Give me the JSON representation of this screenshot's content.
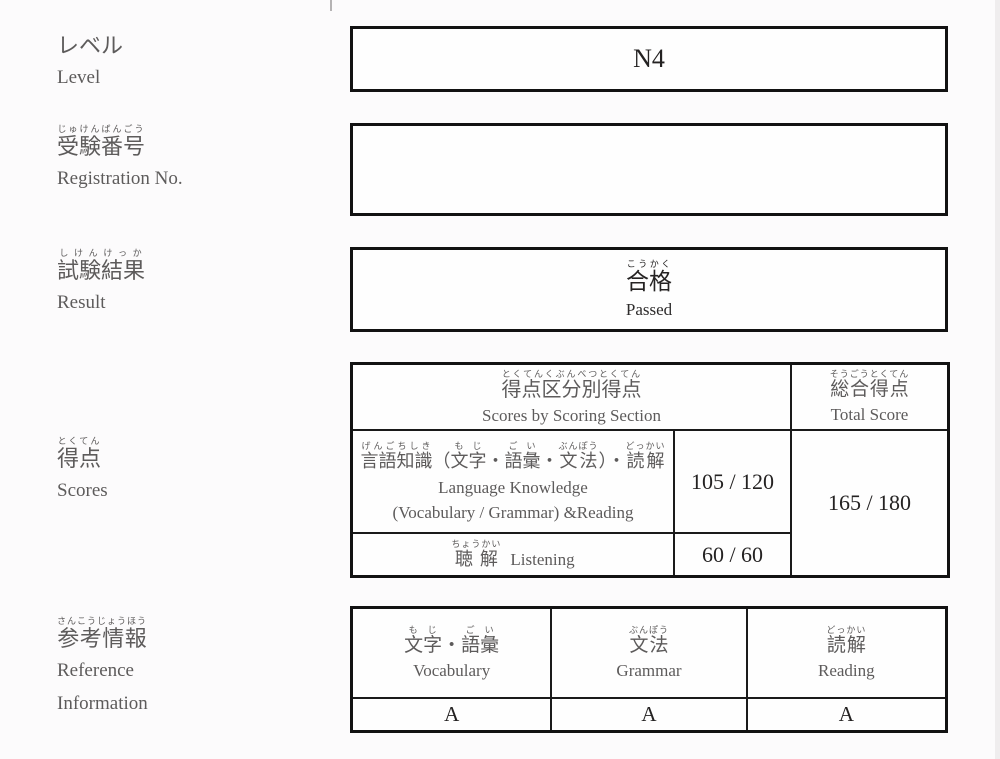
{
  "colors": {
    "background": "#fcfbfc",
    "box_background": "#fefefe",
    "border": "#121212",
    "label_text": "#5d5b5b",
    "value_text": "#242222"
  },
  "fields": {
    "level": {
      "jp": "レベル",
      "en": "Level",
      "value": "N4"
    },
    "registration": {
      "jp_ruby": [
        [
          "じゅけんばんごう",
          "受験番号"
        ]
      ],
      "en": "Registration No.",
      "value": ""
    },
    "result": {
      "jp_ruby": [
        [
          "しけんけっか",
          "試験結果"
        ]
      ],
      "en": "Result",
      "value_jp_ruby": [
        [
          "こうかく",
          "合格"
        ]
      ],
      "value_en": "Passed"
    },
    "scores": {
      "jp_ruby": [
        [
          "とくてん",
          "得点"
        ]
      ],
      "en": "Scores"
    },
    "reference": {
      "jp_ruby": [
        [
          "さんこうじょうほう",
          "参考情報"
        ]
      ],
      "en_line1": "Reference",
      "en_line2": "Information"
    }
  },
  "scores_table": {
    "section_header": {
      "jp_ruby": [
        [
          "とくてんくぶんべつとくてん",
          "得点区分別得点"
        ]
      ],
      "en": "Scores by Scoring Section"
    },
    "total_header": {
      "jp_ruby": [
        [
          "そうごうとくてん",
          "総合得点"
        ]
      ],
      "en": "Total Score"
    },
    "language_row": {
      "jp_ruby": [
        [
          "げんごちしき",
          "言語知識"
        ],
        [
          "",
          "（"
        ],
        [
          "もじ",
          "文字"
        ],
        [
          "",
          "・"
        ],
        [
          "ごい",
          "語彙"
        ],
        [
          "",
          "・"
        ],
        [
          "ぶんぽう",
          "文法"
        ],
        [
          "",
          "）・"
        ],
        [
          "どっかい",
          "読解"
        ]
      ],
      "en_line1": "Language Knowledge",
      "en_line2": "(Vocabulary / Grammar) &Reading",
      "score": "105 / 120"
    },
    "listening_row": {
      "jp_ruby": [
        [
          "ちょうかい",
          "聴解"
        ]
      ],
      "en": "Listening",
      "score": "60 / 60"
    },
    "total_score": "165 / 180"
  },
  "reference_table": {
    "columns": [
      {
        "jp_ruby": [
          [
            "もじ",
            "文字"
          ],
          [
            "",
            "・"
          ],
          [
            "ごい",
            "語彙"
          ]
        ],
        "en": "Vocabulary",
        "grade": "A"
      },
      {
        "jp_ruby": [
          [
            "ぶんぽう",
            "文法"
          ]
        ],
        "en": "Grammar",
        "grade": "A"
      },
      {
        "jp_ruby": [
          [
            "どっかい",
            "読解"
          ]
        ],
        "en": "Reading",
        "grade": "A"
      }
    ]
  }
}
